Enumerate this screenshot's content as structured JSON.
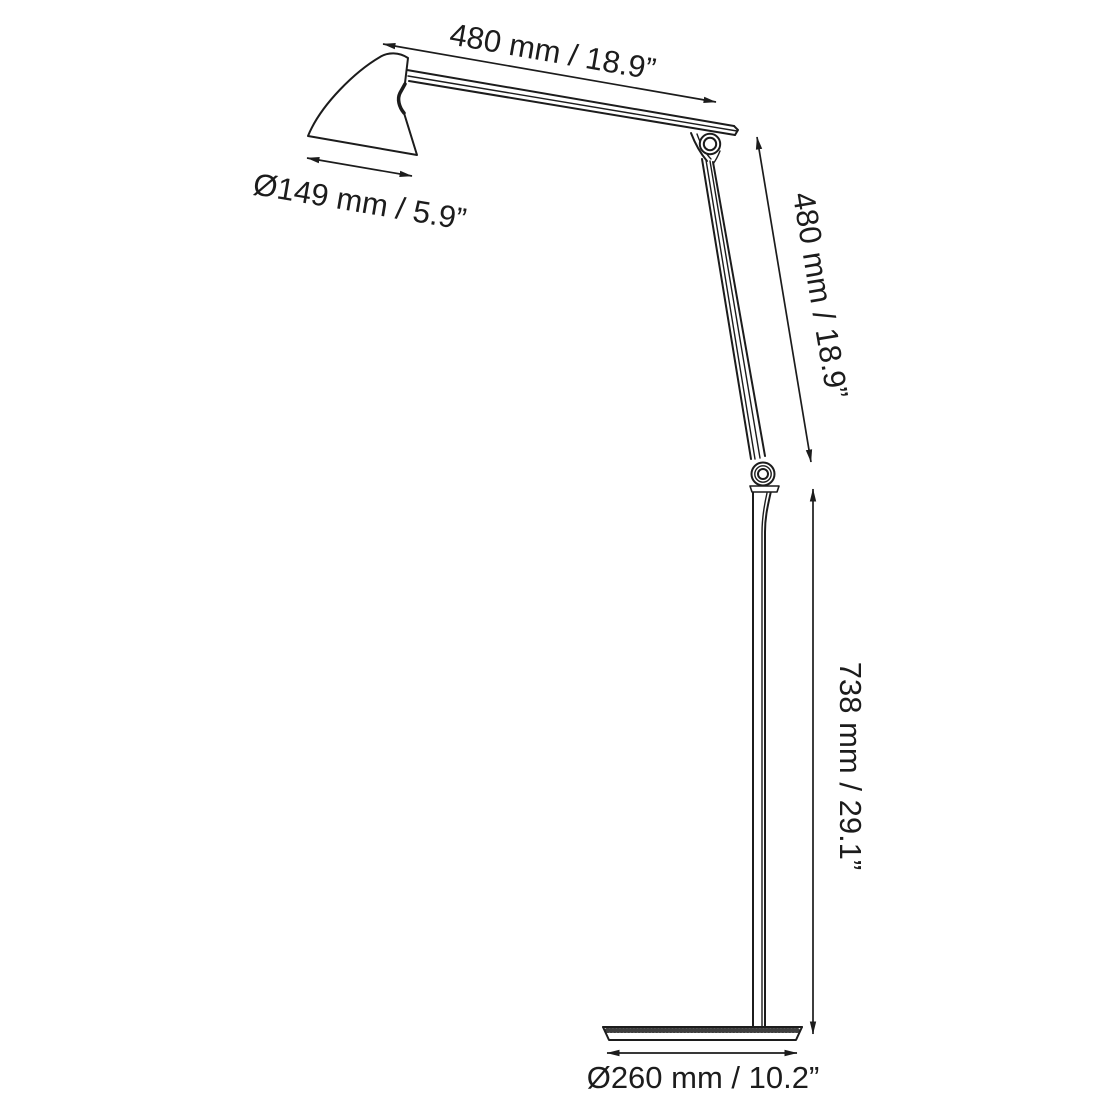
{
  "diagram": {
    "type": "technical-dimension-drawing",
    "subject": "articulated floor lamp, side elevation",
    "colors": {
      "line": "#1c1c1c",
      "background": "#ffffff"
    },
    "labels": {
      "arm_length_top": "480 mm / 18.9”",
      "shade_diameter": "Ø149 mm / 5.9”",
      "arm_length_diagonal": "480 mm / 18.9”",
      "stem_height": "738 mm / 29.1”",
      "base_diameter": "Ø260 mm / 10.2”"
    }
  }
}
